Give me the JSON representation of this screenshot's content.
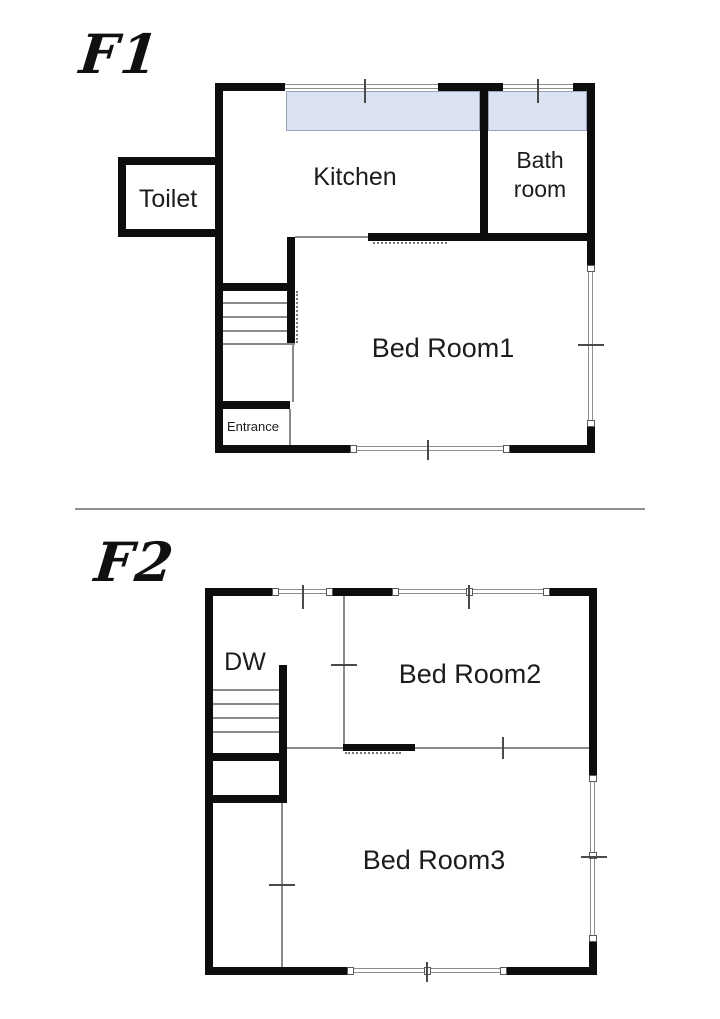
{
  "diagram_title": "Two-floor house floor plan",
  "floor1": {
    "label": "F1",
    "rooms": {
      "toilet": "Toilet",
      "kitchen": "Kitchen",
      "bathroom": "Bath room",
      "bedroom1": "Bed Room1",
      "entrance": "Entrance"
    }
  },
  "floor2": {
    "label": "F2",
    "rooms": {
      "dw": "DW",
      "bedroom2": "Bed Room2",
      "bedroom3": "Bed Room3"
    }
  },
  "colors": {
    "wall": "#0d0d0d",
    "counter": "#dae2f2",
    "counter_border": "#98a3b8",
    "thin_line": "#8a8a8a"
  }
}
